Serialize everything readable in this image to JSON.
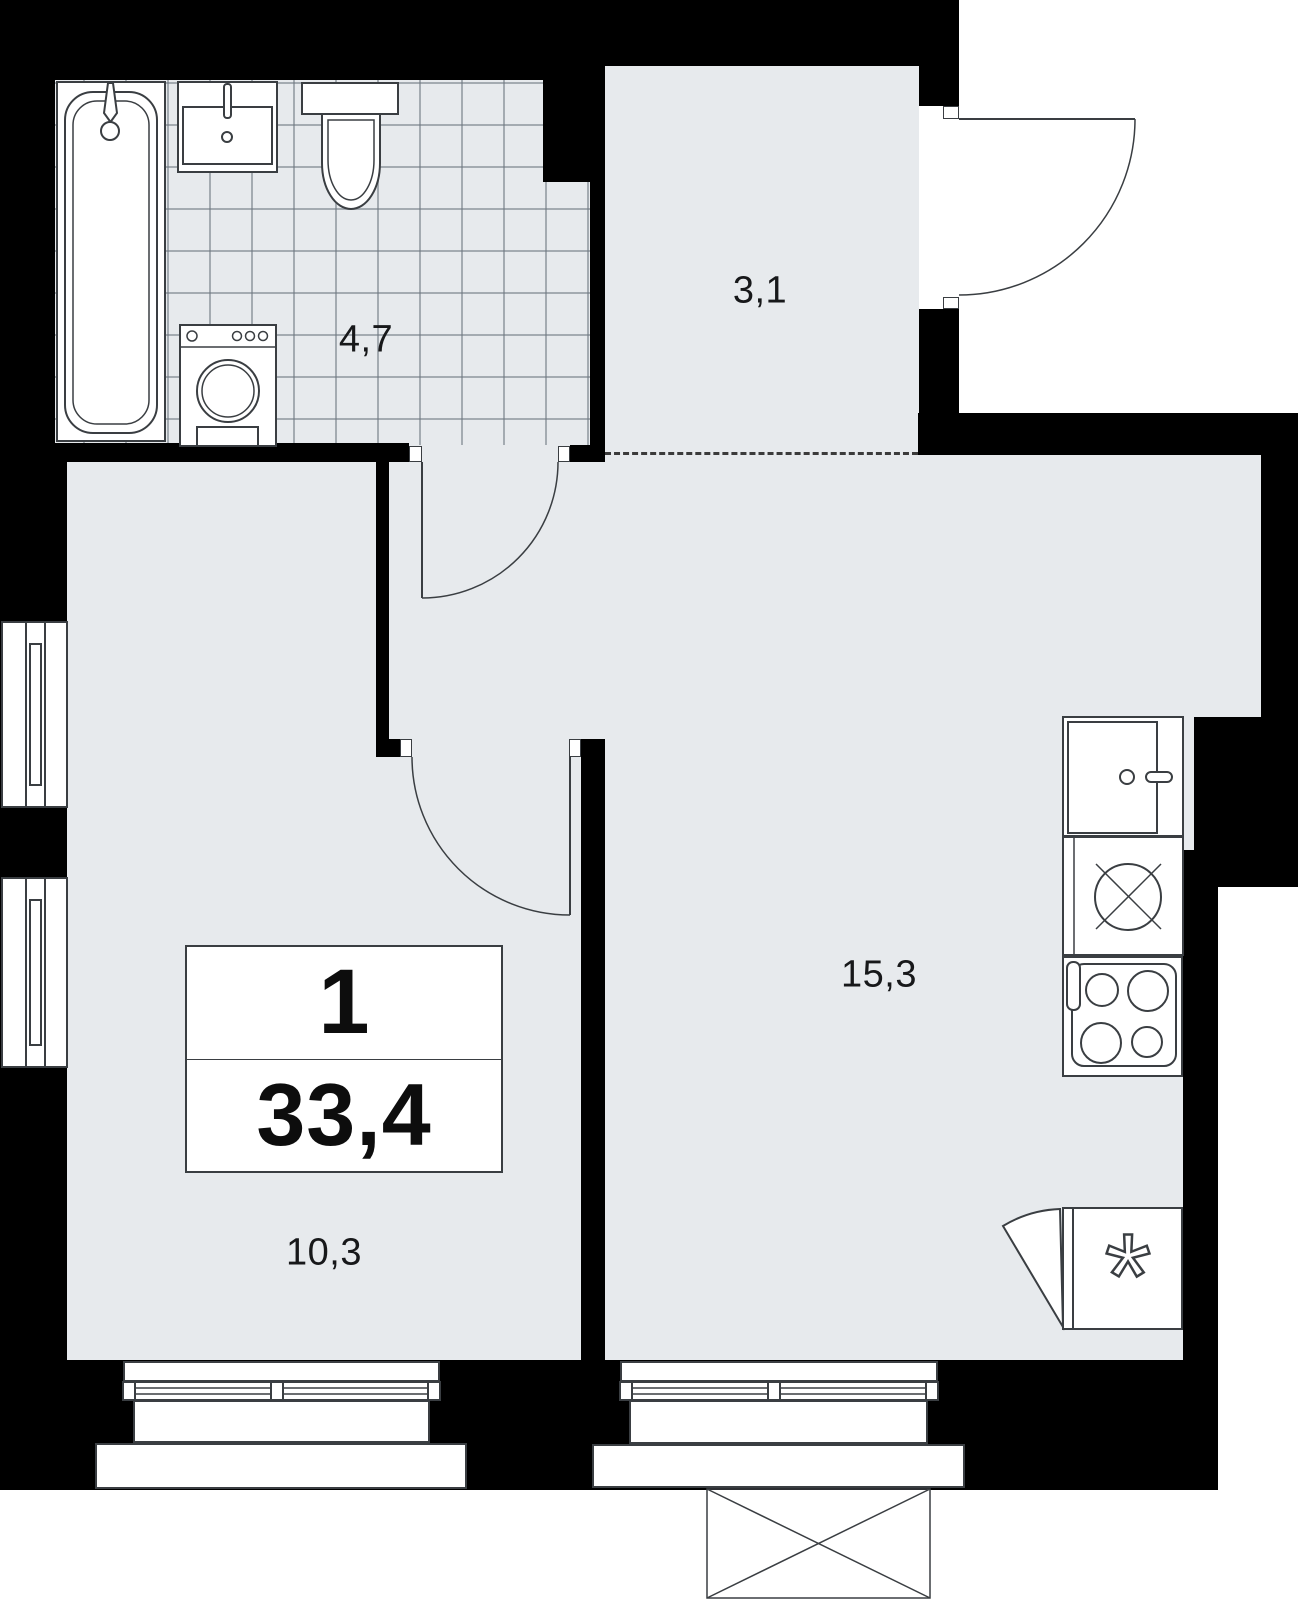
{
  "unit": {
    "rooms_count": "1",
    "total_area": "33,4"
  },
  "rooms": {
    "hallway": {
      "area": "3,1"
    },
    "bathroom": {
      "area": "4,7"
    },
    "living_kitchen": {
      "area": "15,3"
    },
    "room": {
      "area": "10,3"
    }
  },
  "symbols": {
    "fridge_star": "*"
  },
  "fixture_icons": [
    "bathtub-icon",
    "washbasin-icon",
    "toilet-icon",
    "washing-machine-icon",
    "kitchen-sink-icon",
    "hob-icon",
    "stove-icon",
    "fridge-icon",
    "door-swing-icon",
    "window-icon",
    "balcony-icon"
  ],
  "colors": {
    "wall": "#000000",
    "floor": "#e7eaed",
    "outline": "#3a3e42"
  }
}
